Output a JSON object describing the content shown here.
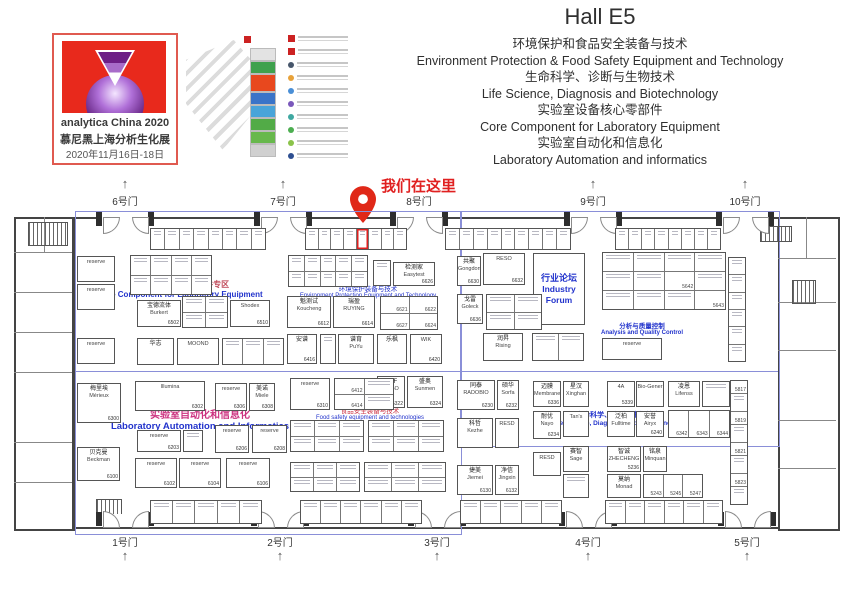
{
  "logo": {
    "line1": "analytica China 2020",
    "line2": "慕尼黑上海分析生化展",
    "line3": "2020年11月16日-18日",
    "red": "#e8291c",
    "purple": "#6d1f86",
    "border": "#e05a50"
  },
  "minimap": {
    "hall_colors": [
      "#e3e3e3",
      "#3fa14d",
      "#e8481e",
      "#3a74c8",
      "#49a4d9",
      "#52ab47",
      "#67b84c",
      "#d0d0d0"
    ],
    "legend_colors": [
      "#47566b",
      "#e8a23a",
      "#4a8fd6",
      "#7a58bb",
      "#3fa8a1",
      "#4cae50",
      "#8bc34a",
      "#2e4f91"
    ],
    "accent": "#cc2222"
  },
  "title": {
    "hall": "Hall E5",
    "lines": [
      "环境保护和食品安全装备与技术",
      "Environment Protection  & Food Safety Equipment and Technology",
      "生命科学、诊断与生物技术",
      "Life Science, Diagnosis and Biotechnology",
      "实验室设备核心零部件",
      "Core Component for Laboratory Equipment",
      "实验室自动化和信息化",
      "Laboratory Automation and informatics"
    ]
  },
  "floorplan": {
    "marker": {
      "text": "我们在这里",
      "color": "#e02020"
    },
    "overlay_color": "#8a8fd8",
    "blue_rects": [
      {
        "x": 75,
        "y": 211,
        "w": 385,
        "h": 322
      },
      {
        "x": 460,
        "y": 211,
        "w": 318,
        "h": 234
      }
    ],
    "blue_lines": [
      {
        "x": 75,
        "y": 371,
        "w": 703,
        "h": 1
      }
    ],
    "gates_top": [
      {
        "label": "6号门",
        "x": 125,
        "arrow": true
      },
      {
        "label": "7号门",
        "x": 283,
        "arrow": true
      },
      {
        "label": "8号门",
        "x": 419,
        "arrow": false
      },
      {
        "label": "9号门",
        "x": 593,
        "arrow": true
      },
      {
        "label": "10号门",
        "x": 745,
        "arrow": true
      }
    ],
    "gates_bottom": [
      {
        "label": "1号门",
        "x": 125
      },
      {
        "label": "2号门",
        "x": 280
      },
      {
        "label": "3号门",
        "x": 437
      },
      {
        "label": "4号门",
        "x": 588
      },
      {
        "label": "5号门",
        "x": 747
      }
    ],
    "zones": [
      {
        "cn": "实验室设备核心/零部件专区",
        "en": "Core Component for Laboratory Equipment",
        "cx": 180,
        "y": 279,
        "cn_color": "#c04a5a",
        "en_color": "#2233cc",
        "cn_fs": 8,
        "en_fs": 8,
        "bold": true
      },
      {
        "cn": "环境保护装备与技术",
        "en": "Environment Protection Equipment and Technology",
        "cx": 368,
        "y": 283,
        "cn_color": "#2233cc",
        "en_color": "#2233cc",
        "cn_fs": 6.5,
        "en_fs": 6,
        "bold": false
      },
      {
        "cn": "分析与质量控制",
        "en": "Analysis and Quality Control",
        "cx": 642,
        "y": 320,
        "cn_color": "#2233cc",
        "en_color": "#2233cc",
        "cn_fs": 6.5,
        "en_fs": 6,
        "bold": true
      },
      {
        "cn": "实验室自动化和信息化",
        "en": "Laboratory Automation and Informatics",
        "cx": 200,
        "y": 406,
        "cn_color": "#cc3380",
        "en_color": "#2233cc",
        "cn_fs": 10,
        "en_fs": 9.5,
        "bold": true
      },
      {
        "cn": "食品安全装备与技术",
        "en": "Food safety equipment and technologies",
        "cx": 370,
        "y": 405,
        "cn_color": "#cc3344",
        "en_color": "#2233cc",
        "cn_fs": 6.5,
        "en_fs": 6,
        "bold": false
      },
      {
        "cn": "生命科学、诊断与生物技术",
        "en": "Life Science, Diagnosis and Biotechnology",
        "cx": 618,
        "y": 410,
        "cn_color": "#2233cc",
        "en_color": "#2233cc",
        "cn_fs": 7,
        "en_fs": 6.5,
        "bold": true
      }
    ],
    "booths": [
      {
        "x": 77,
        "y": 256,
        "w": 38,
        "h": 26,
        "cn": "",
        "en": "reserve",
        "code": ""
      },
      {
        "x": 77,
        "y": 284,
        "w": 38,
        "h": 26,
        "cn": "",
        "en": "reserve",
        "code": ""
      },
      {
        "x": 77,
        "y": 338,
        "w": 38,
        "h": 26,
        "cn": "",
        "en": "reserve",
        "code": ""
      },
      {
        "x": 137,
        "y": 300,
        "w": 44,
        "h": 27,
        "cn": "宝德流体",
        "en": "Burkert",
        "code": "6502"
      },
      {
        "x": 230,
        "y": 300,
        "w": 40,
        "h": 27,
        "cn": "",
        "en": "Shodex",
        "code": "6510"
      },
      {
        "x": 137,
        "y": 338,
        "w": 37,
        "h": 27,
        "cn": "华志",
        "en": "",
        "code": ""
      },
      {
        "x": 177,
        "y": 338,
        "w": 42,
        "h": 27,
        "cn": "",
        "en": "MOOND",
        "code": ""
      },
      {
        "x": 287,
        "y": 296,
        "w": 44,
        "h": 32,
        "cn": "魁测试",
        "en": "Koucheng",
        "code": "6612"
      },
      {
        "x": 333,
        "y": 296,
        "w": 42,
        "h": 32,
        "cn": "瑞盈",
        "en": "RUYING",
        "code": "6614"
      },
      {
        "x": 287,
        "y": 334,
        "w": 30,
        "h": 30,
        "cn": "安谱",
        "en": "",
        "code": "6416"
      },
      {
        "x": 338,
        "y": 334,
        "w": 36,
        "h": 30,
        "cn": "谱育",
        "en": "PuYu",
        "code": ""
      },
      {
        "x": 377,
        "y": 334,
        "w": 30,
        "h": 30,
        "cn": "乐枫",
        "en": "",
        "code": ""
      },
      {
        "x": 410,
        "y": 334,
        "w": 32,
        "h": 30,
        "cn": "",
        "en": "WIK",
        "code": "6420"
      },
      {
        "x": 393,
        "y": 262,
        "w": 42,
        "h": 24,
        "cn": "检测家",
        "en": "Easytest",
        "code": "6626"
      },
      {
        "x": 457,
        "y": 256,
        "w": 24,
        "h": 30,
        "cn": "共聚",
        "en": "Gongdong",
        "code": "6630"
      },
      {
        "x": 483,
        "y": 253,
        "w": 42,
        "h": 32,
        "cn": "",
        "en": "RESO",
        "code": "6632"
      },
      {
        "x": 457,
        "y": 294,
        "w": 26,
        "h": 30,
        "cn": "戈雷",
        "en": "Goleck",
        "code": "6636"
      },
      {
        "x": 533,
        "y": 253,
        "w": 52,
        "h": 72,
        "cn": "行业论坛",
        "en": "Industry Forum",
        "code": "",
        "big": true
      },
      {
        "x": 602,
        "y": 338,
        "w": 60,
        "h": 22,
        "cn": "",
        "en": "reserve",
        "code": ""
      },
      {
        "x": 483,
        "y": 333,
        "w": 40,
        "h": 28,
        "cn": "润昇",
        "en": "Rising",
        "code": ""
      },
      {
        "x": 77,
        "y": 383,
        "w": 44,
        "h": 40,
        "cn": "梅里埃",
        "en": "Mérieux",
        "code": "6300"
      },
      {
        "x": 135,
        "y": 381,
        "w": 70,
        "h": 30,
        "cn": "",
        "en": "Illumina",
        "code": "6302"
      },
      {
        "x": 215,
        "y": 383,
        "w": 32,
        "h": 28,
        "cn": "",
        "en": "reserve",
        "code": "6306"
      },
      {
        "x": 249,
        "y": 383,
        "w": 26,
        "h": 28,
        "cn": "美诺",
        "en": "Miele",
        "code": "6308"
      },
      {
        "x": 137,
        "y": 430,
        "w": 44,
        "h": 22,
        "cn": "",
        "en": "reserve",
        "code": "6203"
      },
      {
        "x": 215,
        "y": 425,
        "w": 34,
        "h": 28,
        "cn": "",
        "en": "reserve",
        "code": "6206"
      },
      {
        "x": 252,
        "y": 425,
        "w": 35,
        "h": 28,
        "cn": "",
        "en": "reserve",
        "code": "6208"
      },
      {
        "x": 77,
        "y": 447,
        "w": 43,
        "h": 34,
        "cn": "贝克曼",
        "en": "Beckman",
        "code": "6100"
      },
      {
        "x": 135,
        "y": 458,
        "w": 42,
        "h": 30,
        "cn": "",
        "en": "reserve",
        "code": "6102"
      },
      {
        "x": 179,
        "y": 458,
        "w": 42,
        "h": 30,
        "cn": "",
        "en": "reserve",
        "code": "6104"
      },
      {
        "x": 226,
        "y": 458,
        "w": 44,
        "h": 30,
        "cn": "",
        "en": "reserve",
        "code": "6106"
      },
      {
        "x": 290,
        "y": 378,
        "w": 40,
        "h": 32,
        "cn": "",
        "en": "reserve",
        "code": "6310"
      },
      {
        "x": 377,
        "y": 376,
        "w": 28,
        "h": 32,
        "cn": "iPaF",
        "en": "RESO",
        "code": "6322"
      },
      {
        "x": 407,
        "y": 376,
        "w": 36,
        "h": 32,
        "cn": "盛奥",
        "en": "Sunmen",
        "code": "6324"
      },
      {
        "x": 457,
        "y": 380,
        "w": 38,
        "h": 30,
        "cn": "同泰",
        "en": "RADOBIO",
        "code": "6230"
      },
      {
        "x": 497,
        "y": 380,
        "w": 22,
        "h": 30,
        "cn": "硕华",
        "en": "Sorfa",
        "code": "6232"
      },
      {
        "x": 457,
        "y": 418,
        "w": 36,
        "h": 30,
        "cn": "科哲",
        "en": "Kezhe",
        "code": ""
      },
      {
        "x": 495,
        "y": 418,
        "w": 24,
        "h": 30,
        "cn": "",
        "en": "RESD",
        "code": ""
      },
      {
        "x": 457,
        "y": 465,
        "w": 36,
        "h": 30,
        "cn": "捷美",
        "en": "Jiemei",
        "code": "6130"
      },
      {
        "x": 495,
        "y": 465,
        "w": 24,
        "h": 30,
        "cn": "净信",
        "en": "Jingxin",
        "code": "6132"
      },
      {
        "x": 533,
        "y": 381,
        "w": 28,
        "h": 26,
        "cn": "迈膜",
        "en": "Membrane",
        "code": "6336"
      },
      {
        "x": 533,
        "y": 411,
        "w": 28,
        "h": 28,
        "cn": "耐优",
        "en": "Nayo",
        "code": "6234"
      },
      {
        "x": 533,
        "y": 452,
        "w": 28,
        "h": 24,
        "cn": "",
        "en": "RESD",
        "code": ""
      },
      {
        "x": 563,
        "y": 381,
        "w": 26,
        "h": 26,
        "cn": "星汉",
        "en": "Xinghan",
        "code": ""
      },
      {
        "x": 607,
        "y": 381,
        "w": 28,
        "h": 26,
        "cn": "",
        "en": "4A",
        "code": "5339"
      },
      {
        "x": 636,
        "y": 381,
        "w": 28,
        "h": 26,
        "cn": "",
        "en": "Bio-Gener",
        "code": ""
      },
      {
        "x": 563,
        "y": 411,
        "w": 26,
        "h": 26,
        "cn": "",
        "en": "Tan's",
        "code": ""
      },
      {
        "x": 607,
        "y": 411,
        "w": 28,
        "h": 26,
        "cn": "泛柏",
        "en": "Fulltime",
        "code": ""
      },
      {
        "x": 636,
        "y": 411,
        "w": 28,
        "h": 26,
        "cn": "安誉",
        "en": "Airyx",
        "code": "6240"
      },
      {
        "x": 668,
        "y": 381,
        "w": 32,
        "h": 26,
        "cn": "凌恩",
        "en": "Lifenss",
        "code": ""
      },
      {
        "x": 563,
        "y": 446,
        "w": 26,
        "h": 26,
        "cn": "赛智",
        "en": "Sage",
        "code": ""
      },
      {
        "x": 607,
        "y": 446,
        "w": 34,
        "h": 26,
        "cn": "智诚",
        "en": "ZHECHENG",
        "code": "5236"
      },
      {
        "x": 643,
        "y": 446,
        "w": 24,
        "h": 26,
        "cn": "铭泉",
        "en": "Minquan",
        "code": ""
      },
      {
        "x": 607,
        "y": 474,
        "w": 34,
        "h": 24,
        "cn": "莫纳",
        "en": "Monad",
        "code": ""
      }
    ],
    "clusters": [
      {
        "x": 130,
        "y": 255,
        "w": 82,
        "h": 40,
        "cols": 4,
        "cells": [
          "",
          "",
          "",
          "",
          "",
          "",
          "",
          ""
        ]
      },
      {
        "x": 182,
        "y": 296,
        "w": 46,
        "h": 32,
        "cols": 2,
        "cells": [
          "",
          "",
          "",
          ""
        ]
      },
      {
        "x": 222,
        "y": 338,
        "w": 62,
        "h": 27,
        "cols": 3,
        "cells": [
          "",
          "",
          ""
        ]
      },
      {
        "x": 288,
        "y": 255,
        "w": 80,
        "h": 32,
        "cols": 5,
        "cells": [
          "",
          "",
          "",
          "",
          "",
          "",
          "",
          "",
          "",
          ""
        ]
      },
      {
        "x": 380,
        "y": 296,
        "w": 58,
        "h": 34,
        "cols": 2,
        "cells": [
          "6621",
          "6622",
          "6627",
          "6624"
        ]
      },
      {
        "x": 486,
        "y": 294,
        "w": 56,
        "h": 36,
        "cols": 2,
        "cells": [
          "",
          "",
          "",
          ""
        ]
      },
      {
        "x": 602,
        "y": 252,
        "w": 124,
        "h": 58,
        "cols": 4,
        "cells": [
          "",
          "",
          "",
          "",
          "",
          "",
          "5642",
          "",
          "",
          "",
          "",
          "5643"
        ]
      },
      {
        "x": 373,
        "y": 260,
        "w": 18,
        "h": 26,
        "cols": 1,
        "cells": [
          ""
        ]
      },
      {
        "x": 320,
        "y": 334,
        "w": 16,
        "h": 30,
        "cols": 1,
        "cells": [
          ""
        ]
      },
      {
        "x": 183,
        "y": 430,
        "w": 20,
        "h": 22,
        "cols": 1,
        "cells": [
          ""
        ]
      },
      {
        "x": 334,
        "y": 378,
        "w": 60,
        "h": 32,
        "cols": 2,
        "cells": [
          "6412",
          "",
          "6414",
          ""
        ]
      },
      {
        "x": 290,
        "y": 420,
        "w": 74,
        "h": 32,
        "cols": 3,
        "cells": [
          "",
          "",
          "",
          "",
          "",
          ""
        ]
      },
      {
        "x": 368,
        "y": 420,
        "w": 76,
        "h": 32,
        "cols": 3,
        "cells": [
          "",
          "",
          "",
          "",
          "",
          ""
        ]
      },
      {
        "x": 290,
        "y": 462,
        "w": 70,
        "h": 30,
        "cols": 3,
        "cells": [
          "",
          "",
          "",
          "",
          "",
          ""
        ]
      },
      {
        "x": 364,
        "y": 462,
        "w": 82,
        "h": 30,
        "cols": 3,
        "cells": [
          "",
          "",
          "",
          "",
          "",
          ""
        ]
      },
      {
        "x": 668,
        "y": 410,
        "w": 62,
        "h": 28,
        "cols": 3,
        "cells": [
          "6342",
          "6343",
          "6344"
        ]
      },
      {
        "x": 643,
        "y": 474,
        "w": 60,
        "h": 24,
        "cols": 3,
        "cells": [
          "5243",
          "5245",
          "5247"
        ]
      },
      {
        "x": 532,
        "y": 333,
        "w": 52,
        "h": 28,
        "cols": 2,
        "cells": [
          "",
          ""
        ]
      },
      {
        "x": 563,
        "y": 474,
        "w": 26,
        "h": 24,
        "cols": 1,
        "cells": [
          ""
        ]
      },
      {
        "x": 702,
        "y": 381,
        "w": 28,
        "h": 26,
        "cols": 1,
        "cells": [
          ""
        ]
      },
      {
        "x": 728,
        "y": 257,
        "w": 18,
        "h": 105,
        "cols": 1,
        "cells": [
          "",
          "",
          "",
          "",
          "",
          ""
        ]
      },
      {
        "x": 730,
        "y": 380,
        "w": 18,
        "h": 125,
        "cols": 1,
        "cells": [
          "5817",
          "",
          "5819",
          "",
          "5821",
          "",
          "5823",
          ""
        ]
      }
    ],
    "strips_top": [
      {
        "x": 150,
        "y": 228,
        "w": 116,
        "h": 22,
        "n": 8
      },
      {
        "x": 305,
        "y": 228,
        "w": 102,
        "h": 22,
        "n": 8,
        "hi": 4
      },
      {
        "x": 445,
        "y": 228,
        "w": 126,
        "h": 22,
        "n": 9
      },
      {
        "x": 615,
        "y": 228,
        "w": 106,
        "h": 22,
        "n": 8
      }
    ],
    "strips_bottom": [
      {
        "x": 150,
        "y": 500,
        "w": 112,
        "h": 24,
        "n": 5
      },
      {
        "x": 300,
        "y": 500,
        "w": 122,
        "h": 24,
        "n": 6
      },
      {
        "x": 460,
        "y": 500,
        "w": 102,
        "h": 24,
        "n": 5
      },
      {
        "x": 605,
        "y": 500,
        "w": 118,
        "h": 24,
        "n": 6
      }
    ],
    "stairs": [
      {
        "x": 28,
        "y": 222,
        "w": 38,
        "h": 22
      },
      {
        "x": 760,
        "y": 226,
        "w": 30,
        "h": 14
      },
      {
        "x": 792,
        "y": 280,
        "w": 22,
        "h": 22
      },
      {
        "x": 96,
        "y": 499,
        "w": 24,
        "h": 20
      }
    ],
    "hlines": [
      {
        "x": 14,
        "y": 252,
        "w": 58,
        "h": 1
      },
      {
        "x": 14,
        "y": 292,
        "w": 58,
        "h": 1
      },
      {
        "x": 14,
        "y": 332,
        "w": 58,
        "h": 1
      },
      {
        "x": 14,
        "y": 372,
        "w": 58,
        "h": 1
      },
      {
        "x": 14,
        "y": 442,
        "w": 58,
        "h": 1
      },
      {
        "x": 14,
        "y": 482,
        "w": 58,
        "h": 1
      },
      {
        "x": 44,
        "y": 217,
        "w": 1,
        "h": 35
      },
      {
        "x": 778,
        "y": 258,
        "w": 58,
        "h": 1
      },
      {
        "x": 778,
        "y": 302,
        "w": 58,
        "h": 1
      },
      {
        "x": 778,
        "y": 350,
        "w": 58,
        "h": 1
      },
      {
        "x": 778,
        "y": 420,
        "w": 58,
        "h": 1
      },
      {
        "x": 778,
        "y": 468,
        "w": 58,
        "h": 1
      },
      {
        "x": 806,
        "y": 217,
        "w": 1,
        "h": 41
      }
    ]
  }
}
